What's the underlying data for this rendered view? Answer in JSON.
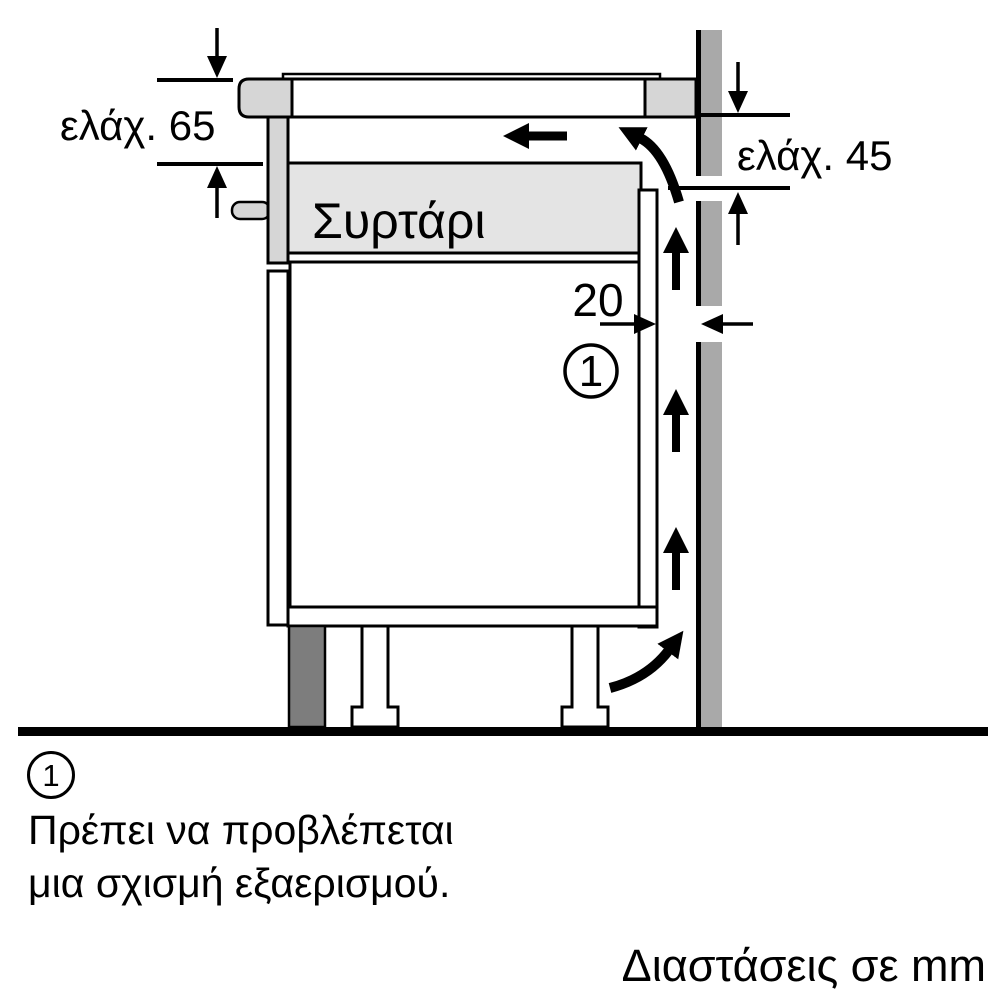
{
  "diagram": {
    "dim_top_left": "ελάχ. 65",
    "dim_right": "ελάχ. 45",
    "dim_gap": "20",
    "drawer_label": "Συρτάρι",
    "callout_number": "1",
    "colors": {
      "light_gray": "#d6d6d6",
      "drawer_gray": "#e4e4e4",
      "wall_gray": "#a9a9a9",
      "plinth_gray": "#7d7d7d",
      "ink": "#000000"
    }
  },
  "footnote": {
    "marker": "1",
    "line1": "Πρέπει να προβλέπεται",
    "line2": "μια σχισμή εξαερισμού."
  },
  "units_note": "Διαστάσεις σε mm"
}
